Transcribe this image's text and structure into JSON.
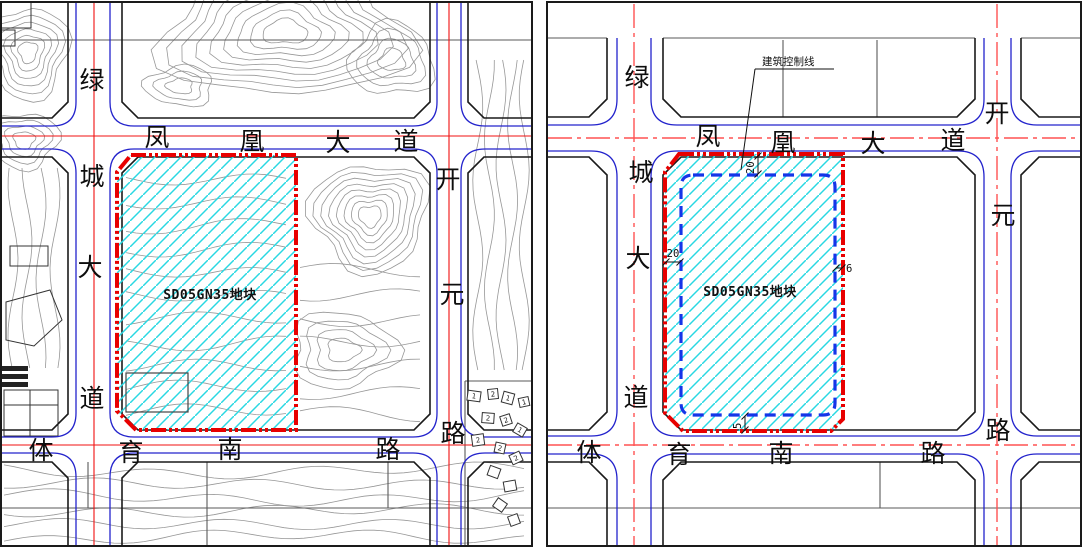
{
  "left_panel": {
    "parcel_label": "SD05GN35地块",
    "roads": {
      "north": {
        "name": "凤凰大道",
        "chars": [
          "凤",
          "凰",
          "大",
          "道"
        ]
      },
      "west": {
        "name": "绿城大道",
        "chars": [
          "绿",
          "城",
          "大",
          "道"
        ]
      },
      "east": {
        "name": "开元路",
        "chars": [
          "开",
          "元",
          "路"
        ]
      },
      "south": {
        "name": "体育南路",
        "chars": [
          "体",
          "育",
          "南",
          "路"
        ]
      }
    },
    "house_story_numbers": [
      "1",
      "2",
      "1",
      "1",
      "2",
      "2",
      "1",
      "2",
      "2",
      "2"
    ]
  },
  "right_panel": {
    "parcel_label": "SD05GN35地块",
    "control_line_label": "建筑控制线",
    "dimensions": {
      "north_setback": "20",
      "west_setback": "20",
      "east_setback": "6",
      "south_setback": "5"
    },
    "roads": {
      "north": {
        "name": "凤凰大道",
        "chars": [
          "凤",
          "凰",
          "大",
          "道"
        ]
      },
      "west": {
        "name": "绿城大道",
        "chars": [
          "绿",
          "城",
          "大",
          "道"
        ]
      },
      "east": {
        "name": "开元路",
        "chars": [
          "开",
          "元",
          "路"
        ]
      },
      "south": {
        "name": "体育南路",
        "chars": [
          "体",
          "育",
          "南",
          "路"
        ]
      }
    }
  },
  "colors": {
    "parcel_boundary_red": "#e80000",
    "building_control_blue": "#1535e8",
    "hatch_cyan": "#29d8e2",
    "road_edge_blue": "#2323cc",
    "centerline_red": "#f01010",
    "centerline_pink": "#ff5252",
    "contour_gray": "#979797",
    "block_line_gray": "#5a5a5a",
    "frame_black": "#1a1a1a"
  }
}
